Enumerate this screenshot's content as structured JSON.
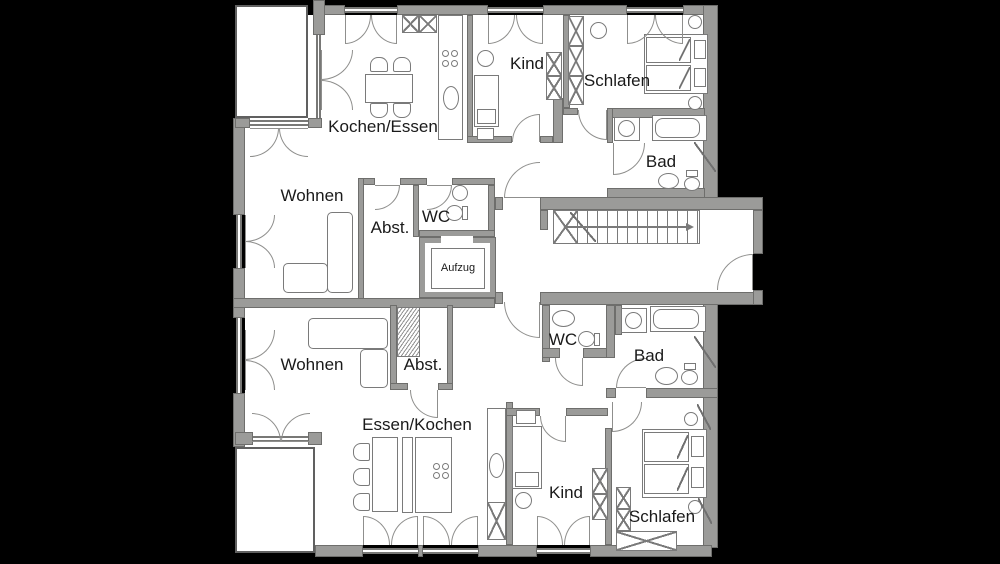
{
  "plan_title": "Apartment floor plan",
  "colors": {
    "background": "#000000",
    "wall": "#9b9b99",
    "wall_outline": "#6e6e6c",
    "line": "#7a7a7a",
    "floor": "#ffffff",
    "text": "#1a1a1a"
  },
  "rooms": {
    "top": {
      "kitchen_dining": "Kochen/Essen",
      "child": "Kind",
      "bedroom": "Schlafen",
      "bathroom": "Bad",
      "living": "Wohnen",
      "storage": "Abst.",
      "wc": "WC"
    },
    "core": {
      "elevator": "Aufzug"
    },
    "bottom": {
      "living": "Wohnen",
      "storage": "Abst.",
      "wc": "WC",
      "bathroom": "Bad",
      "dining_kitchen": "Essen/Kochen",
      "child": "Kind",
      "bedroom": "Schlafen"
    }
  }
}
